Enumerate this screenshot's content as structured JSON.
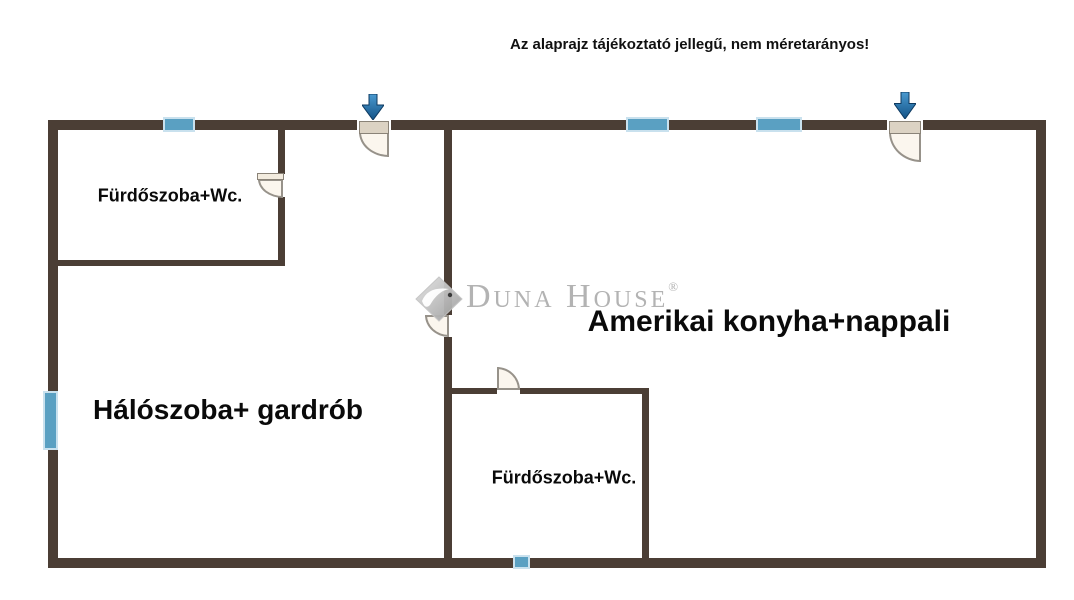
{
  "disclaimer": "Az alaprajz tájékoztató jellegű, nem méretarányos!",
  "watermark": {
    "brand": "Duna House",
    "registered_mark": "®"
  },
  "rooms": [
    {
      "name": "bathroom-top-left",
      "label": "Fürdőszoba+Wc."
    },
    {
      "name": "bedroom-wardrobe",
      "label": "Hálószoba+ gardrób"
    },
    {
      "name": "kitchen-living",
      "label": "Amerikai konyha+nappali"
    },
    {
      "name": "bathroom-bottom",
      "label": "Fürdőszoba+Wc."
    }
  ],
  "icons": {
    "entrance_arrow": "down-arrow-icon",
    "logo_diamond": "duna-house-diamond-icon"
  },
  "colors": {
    "wall": "#4b3e35",
    "window_fill": "#5aa0c2",
    "window_border": "#c9e1ee",
    "arrow_fill_top": "#4a9ad0",
    "arrow_fill_bottom": "#135286",
    "door_fill": "#fbf6ee",
    "door_leaf": "#dcd3c4",
    "logo_gray": "#b3b3b3",
    "label_text": "#0a0a0a"
  }
}
